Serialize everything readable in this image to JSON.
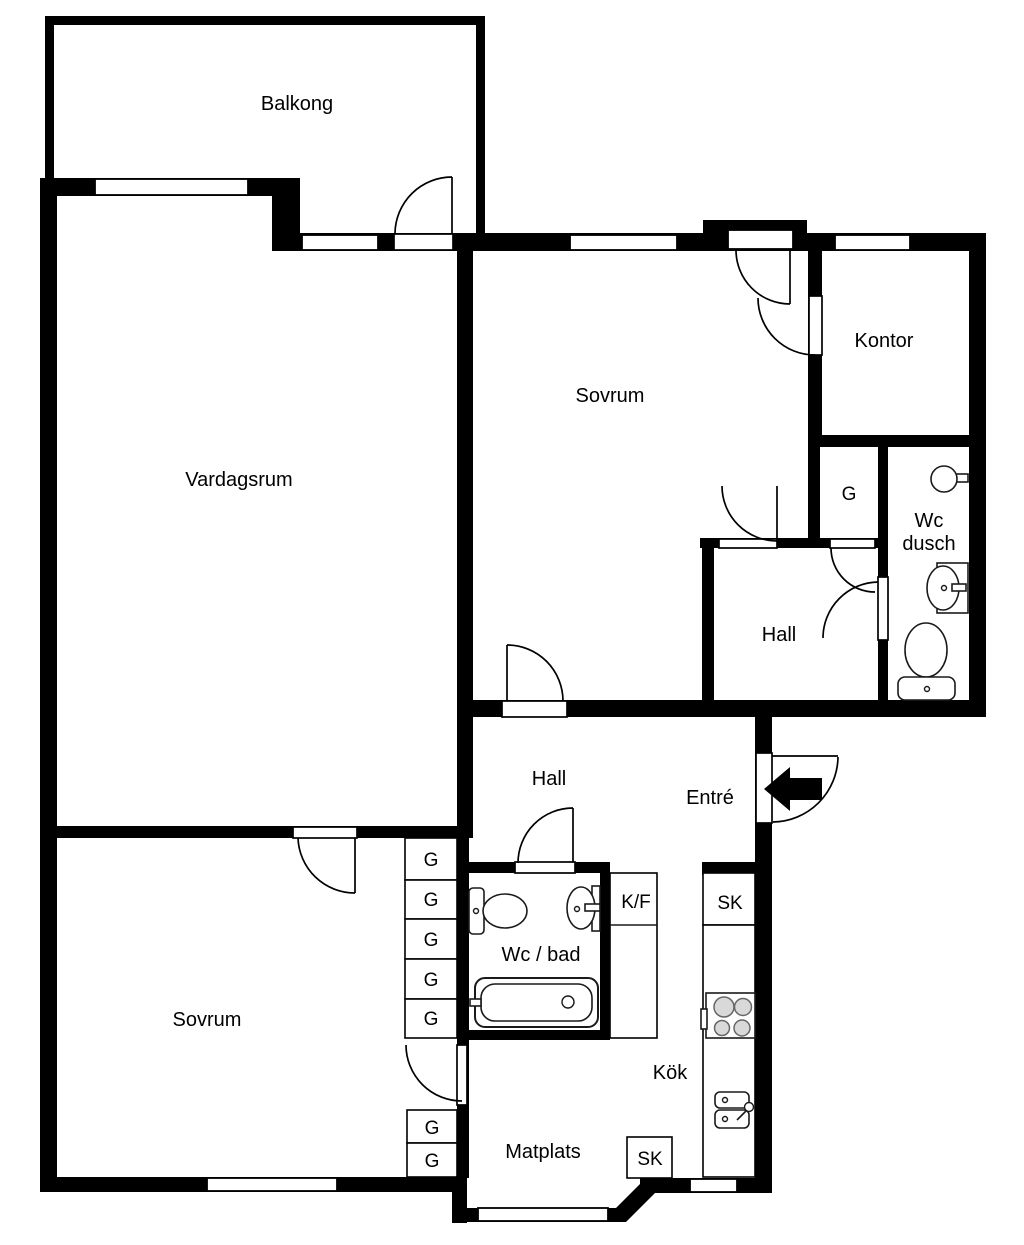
{
  "labels": {
    "balkong": "Balkong",
    "vardagsrum": "Vardagsrum",
    "sovrum": "Sovrum",
    "kontor": "Kontor",
    "wc_dusch_line1": "Wc",
    "wc_dusch_line2": "dusch",
    "hall": "Hall",
    "entre": "Entré",
    "wc_bad": "Wc / bad",
    "kok": "Kök",
    "matplats": "Matplats",
    "g": "G",
    "kf": "K/F",
    "sk": "SK"
  },
  "colors": {
    "wall": "#000000",
    "background": "#ffffff",
    "fixture_line": "#1a1a1a",
    "burner_fill": "#d9d9d9"
  }
}
